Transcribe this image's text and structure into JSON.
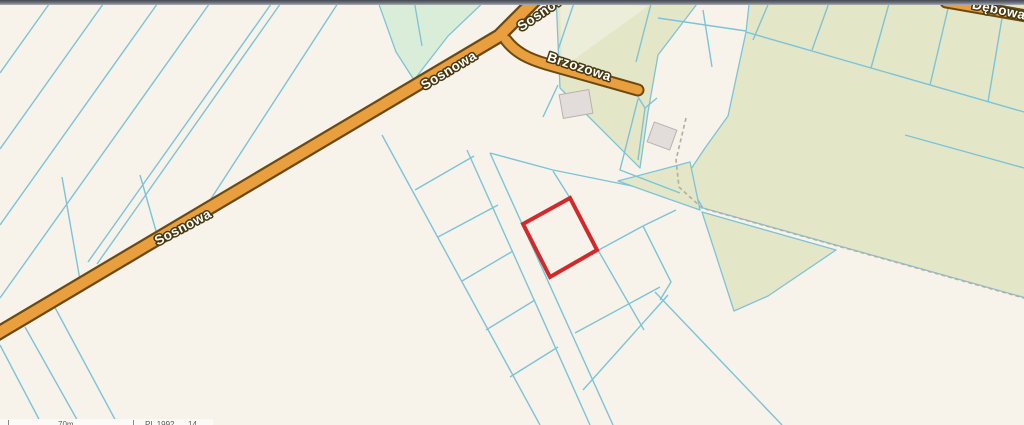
{
  "map": {
    "streets": {
      "sosnowa_sw": "Sosnowa",
      "sosnowa_mid": "Sosnowa",
      "sosnowa_top": "Sosnowa",
      "brzozowa": "Brzozowa",
      "debowa": "Dębowa"
    },
    "highlight": {
      "description": "selected parcel outline"
    }
  },
  "scalebar": {
    "distance": "70m",
    "crs": "PL 1992",
    "right_value": "14"
  },
  "colors": {
    "background": "#f7f3ea",
    "parcel_line": "#7cc3d8",
    "road_fill": "#e99f3d",
    "road_casing": "#6b4a12",
    "field_olive": "#e4e7c7",
    "field_olive_light": "#edeeda",
    "field_mint": "#d9edd8",
    "building_fill": "#e2dddb",
    "building_stroke": "#b8b1ad",
    "highlight_red": "#d2292b",
    "path_dash": "#b6afa3"
  }
}
